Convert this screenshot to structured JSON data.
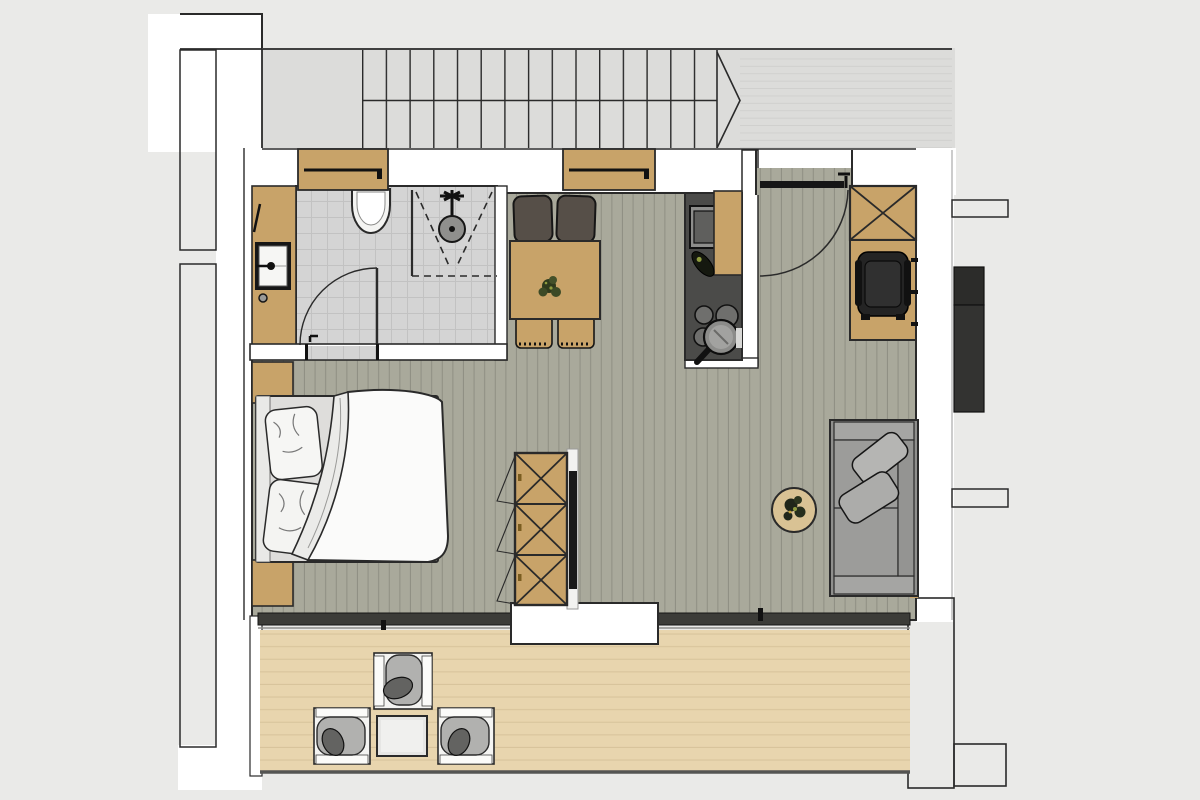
{
  "scene": {
    "kind": "apartment-floor-plan",
    "view": "top-down-rendered",
    "text_labels": [],
    "rooms": [
      {
        "name": "stairwell",
        "features": [
          "staircase-treads",
          "stair-break-symbol",
          "landing"
        ]
      },
      {
        "name": "bathroom",
        "features": [
          "wall-hung-toilet",
          "shower-with-glass",
          "vanity-sink",
          "towel-radiator",
          "swing-door",
          "tiled-floor"
        ]
      },
      {
        "name": "hall",
        "features": [
          "entrance-door-with-swing",
          "x-marked-wardrobe",
          "coat-niche-with-rail"
        ]
      },
      {
        "name": "kitchen",
        "features": [
          "dark-counter",
          "sink",
          "cutting-board",
          "bottle",
          "cooktop-burners",
          "pan"
        ]
      },
      {
        "name": "dining",
        "features": [
          "square-table",
          "potted-plant",
          "two-upholstered-chairs",
          "two-wood-chairs"
        ]
      },
      {
        "name": "living-sleeping",
        "features": [
          "double-bed",
          "pillows",
          "duvet",
          "nightstands",
          "x-marked-sideboard",
          "tv-panel",
          "desk",
          "office-chair",
          "sofa",
          "throw-pillows",
          "round-side-table-with-plant",
          "plank-floor"
        ]
      },
      {
        "name": "balcony",
        "features": [
          "wood-deck",
          "three-armchairs",
          "coffee-table",
          "window-band"
        ]
      }
    ]
  },
  "colors": {
    "canvas": "#eaeae8",
    "common": "#dcdcda",
    "pier": "#d6d6d4",
    "wall": "#ffffff",
    "line": "#2a2a2a",
    "tile": "#d4d4d4",
    "tile_line": "#c2c2c2",
    "living": "#a9a99b",
    "living_line": "#909084",
    "deck": "#e8d5ae",
    "deck_line": "#d8c49c",
    "wood": "#c8a369",
    "wood_light": "#d9c294",
    "counter": "#4b4b49",
    "window_band": "#3c3c38",
    "sofa": "#8f8f8d",
    "sofa_arm": "#a5a5a3",
    "sofa_pillow": "#b5b5b3",
    "chair_brown": "#564f48",
    "office_chair": "#242424",
    "shaft": "#333331",
    "fixture": "#f4f4f2",
    "plant_dark": "#2f3a1d",
    "plant_light": "#8f9c3f",
    "tv": "#1a1a1a",
    "duvet": "#fbfbfa"
  }
}
